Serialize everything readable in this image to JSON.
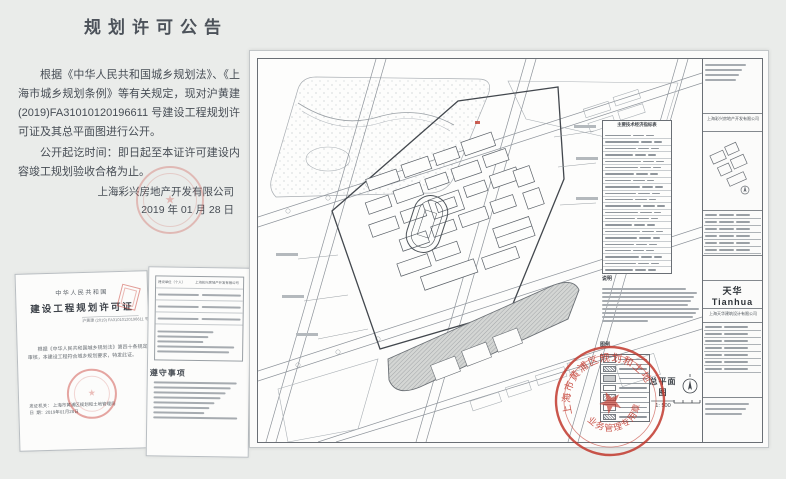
{
  "announcement": {
    "title": "规划许可公告",
    "para1": "根据《中华人民共和国城乡规划法》、《上海市城乡规划条例》等有关规定，现对沪黄建 (2019)FA31010120196611 号建设工程规划许可证及其总平面图进行公开。",
    "para2": "公开起讫时间：即日起至本证许可建设内容竣工规划验收合格为止。",
    "company": "上海彩兴房地产开发有限公司",
    "date": "2019 年 01 月 28 日"
  },
  "certificate": {
    "country": "中华人民共和国",
    "title": "建设工程规划许可证",
    "permit_no": "沪黄建 (2019) FA31010120196611 号",
    "body": "根据《中华人民共和国城乡规划法》第四十条规定，经审核，本建设工程符合城乡规划要求，特发此证。",
    "issuer_label": "发证机关",
    "issuer": "上海市黄浦区规划和土地管理局",
    "issue_date": "2019年01月28日",
    "page2_field_label": "建设单位（个人）",
    "page2_field_value": "上海彩兴房地产开发有限公司",
    "rules_title": "遵守事项"
  },
  "drawing": {
    "indicator_title": "主要技术经济指标表",
    "notes_title": "说明",
    "legend_title": "图例",
    "plan_label": "总平面图",
    "plan_scale": "1: 500",
    "firm_logo": "天华Tianhua",
    "firm_name": "上海天华建筑设计有限公司",
    "client_name": "上海彩兴房地产开发有限公司",
    "stamp_text_outer": "上海市黄浦区规划和土地管理局",
    "stamp_text_inner": "业务管理专用章",
    "indicator_rows": 24,
    "notes_lines": 9,
    "legend_rows": 7,
    "sig_rows": 7
  }
}
